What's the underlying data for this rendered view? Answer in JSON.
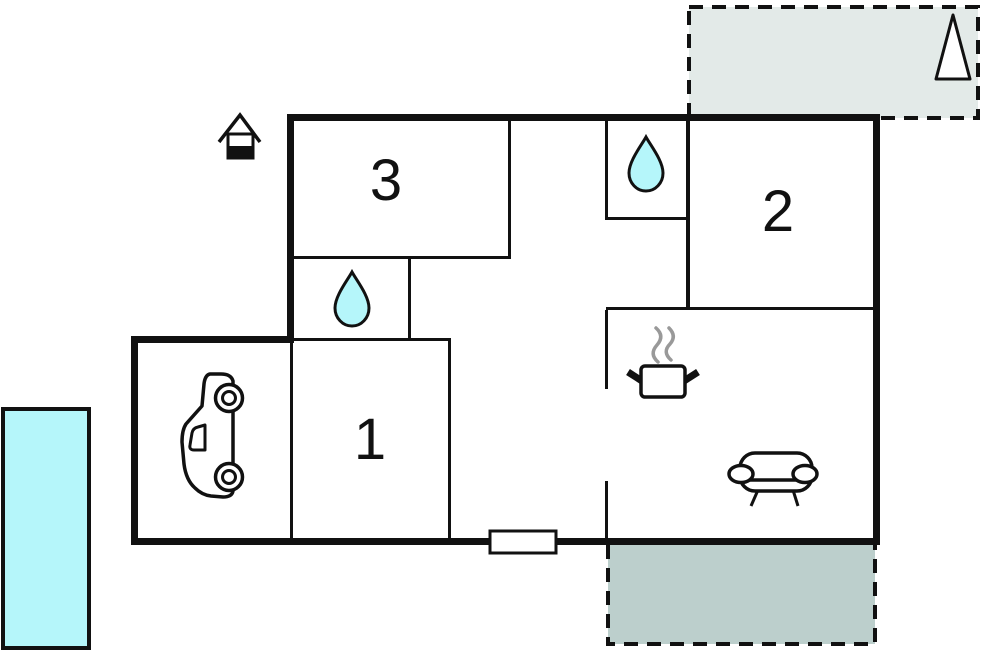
{
  "plan_type": "vacation-home-floor-plan",
  "rooms": [
    {
      "label": "1"
    },
    {
      "label": "2"
    },
    {
      "label": "3"
    }
  ],
  "icons": [
    {
      "name": "water-drop-icon",
      "count": 2
    },
    {
      "name": "car-icon",
      "count": 1
    },
    {
      "name": "cooking-pot-icon",
      "count": 1
    },
    {
      "name": "sofa-icon",
      "count": 1
    },
    {
      "name": "house-entrance-icon",
      "count": 1
    },
    {
      "name": "north-triangle-icon",
      "count": 1
    },
    {
      "name": "window-symbol",
      "count": 1
    }
  ],
  "colors": {
    "wall": "#111111",
    "water": "#b5f6fa",
    "pool": "#b5f6fa",
    "terrace_top": "#e3eae8",
    "terrace_bottom": "#bccfcc",
    "steam": "#999999",
    "background": "#ffffff"
  }
}
